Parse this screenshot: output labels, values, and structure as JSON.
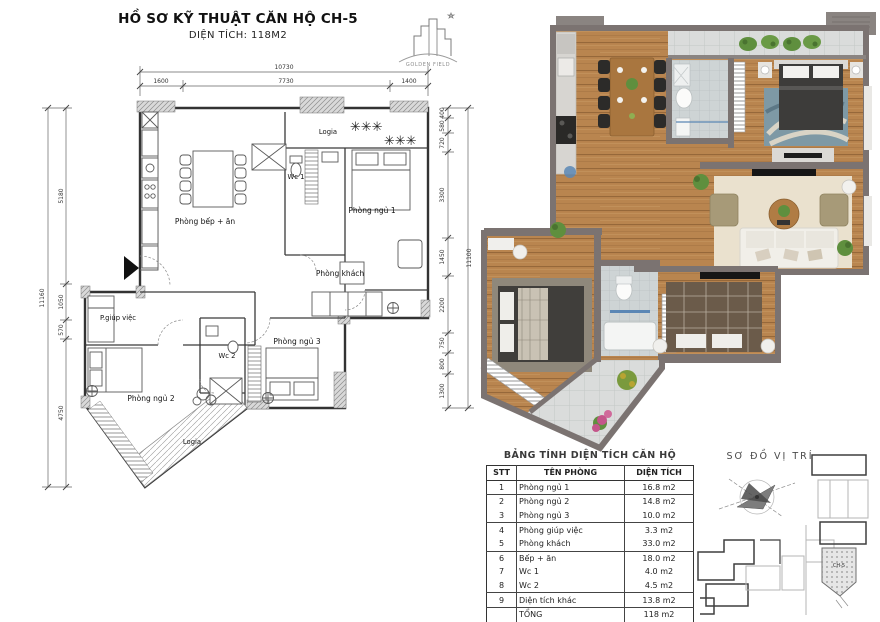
{
  "header": {
    "title": "HỒ SƠ KỸ THUẬT CĂN HỘ CH-5",
    "subtitle": "DIỆN TÍCH: 118M2"
  },
  "logo": {
    "brand": "GOLDEN FIELD"
  },
  "left_plan": {
    "rooms": {
      "kitchen": "Phòng bếp + ăn",
      "wc1": "Wc 1",
      "bedroom1": "Phòng ngủ 1",
      "living": "Phòng khách",
      "maid": "P.giúp việc",
      "bedroom2": "Phòng ngủ 2",
      "wc2": "Wc 2",
      "bedroom3": "Phòng ngủ 3",
      "logia_top": "Logia",
      "logia_bottom": "Logia"
    },
    "dims": {
      "top_total": "10730",
      "top_segments": [
        "1600",
        "7730",
        "1400"
      ],
      "left_total": "11160",
      "left_segments": [
        "5180",
        "1050",
        "570",
        "4750"
      ],
      "right_total": "11100",
      "right_segments": [
        "400",
        "580",
        "720",
        "3300",
        "1450",
        "2200",
        "750",
        "800",
        "1300"
      ]
    }
  },
  "area_table": {
    "title": "BẢNG TÍNH DIỆN TÍCH CĂN HỘ",
    "columns": [
      "STT",
      "TÊN PHÒNG",
      "DIỆN TÍCH"
    ],
    "rows": [
      {
        "stt": "1",
        "name": "Phòng ngủ 1",
        "area": "16.8 m2"
      },
      {
        "stt": "2",
        "name": "Phòng ngủ 2",
        "area": "14.8 m2"
      },
      {
        "stt": "3",
        "name": "Phòng ngủ 3",
        "area": "10.0 m2"
      },
      {
        "stt": "4",
        "name": "Phòng giúp việc",
        "area": "3.3 m2"
      },
      {
        "stt": "5",
        "name": "Phòng khách",
        "area": "33.0 m2"
      },
      {
        "stt": "6",
        "name": "Bếp + ăn",
        "area": "18.0 m2"
      },
      {
        "stt": "7",
        "name": "Wc 1",
        "area": "4.0 m2"
      },
      {
        "stt": "8",
        "name": "Wc 2",
        "area": "4.5 m2"
      },
      {
        "stt": "9",
        "name": "Diện tích khác",
        "area": "13.8 m2"
      },
      {
        "stt": "",
        "name": "TỔNG",
        "area": "118 m2"
      }
    ]
  },
  "location": {
    "title": "SƠ ĐỒ VỊ TRÍ",
    "unit_label": "CH-5"
  },
  "colors": {
    "wood_floor": "#b9854f",
    "render_wall": "#7b7371",
    "tile": "#dadcdb",
    "rug_bedroom1": "#7e99a5",
    "rug_living": "#eae1ce",
    "plant_green": "#5f8f3e",
    "line_ink": "#3a3a3a"
  }
}
